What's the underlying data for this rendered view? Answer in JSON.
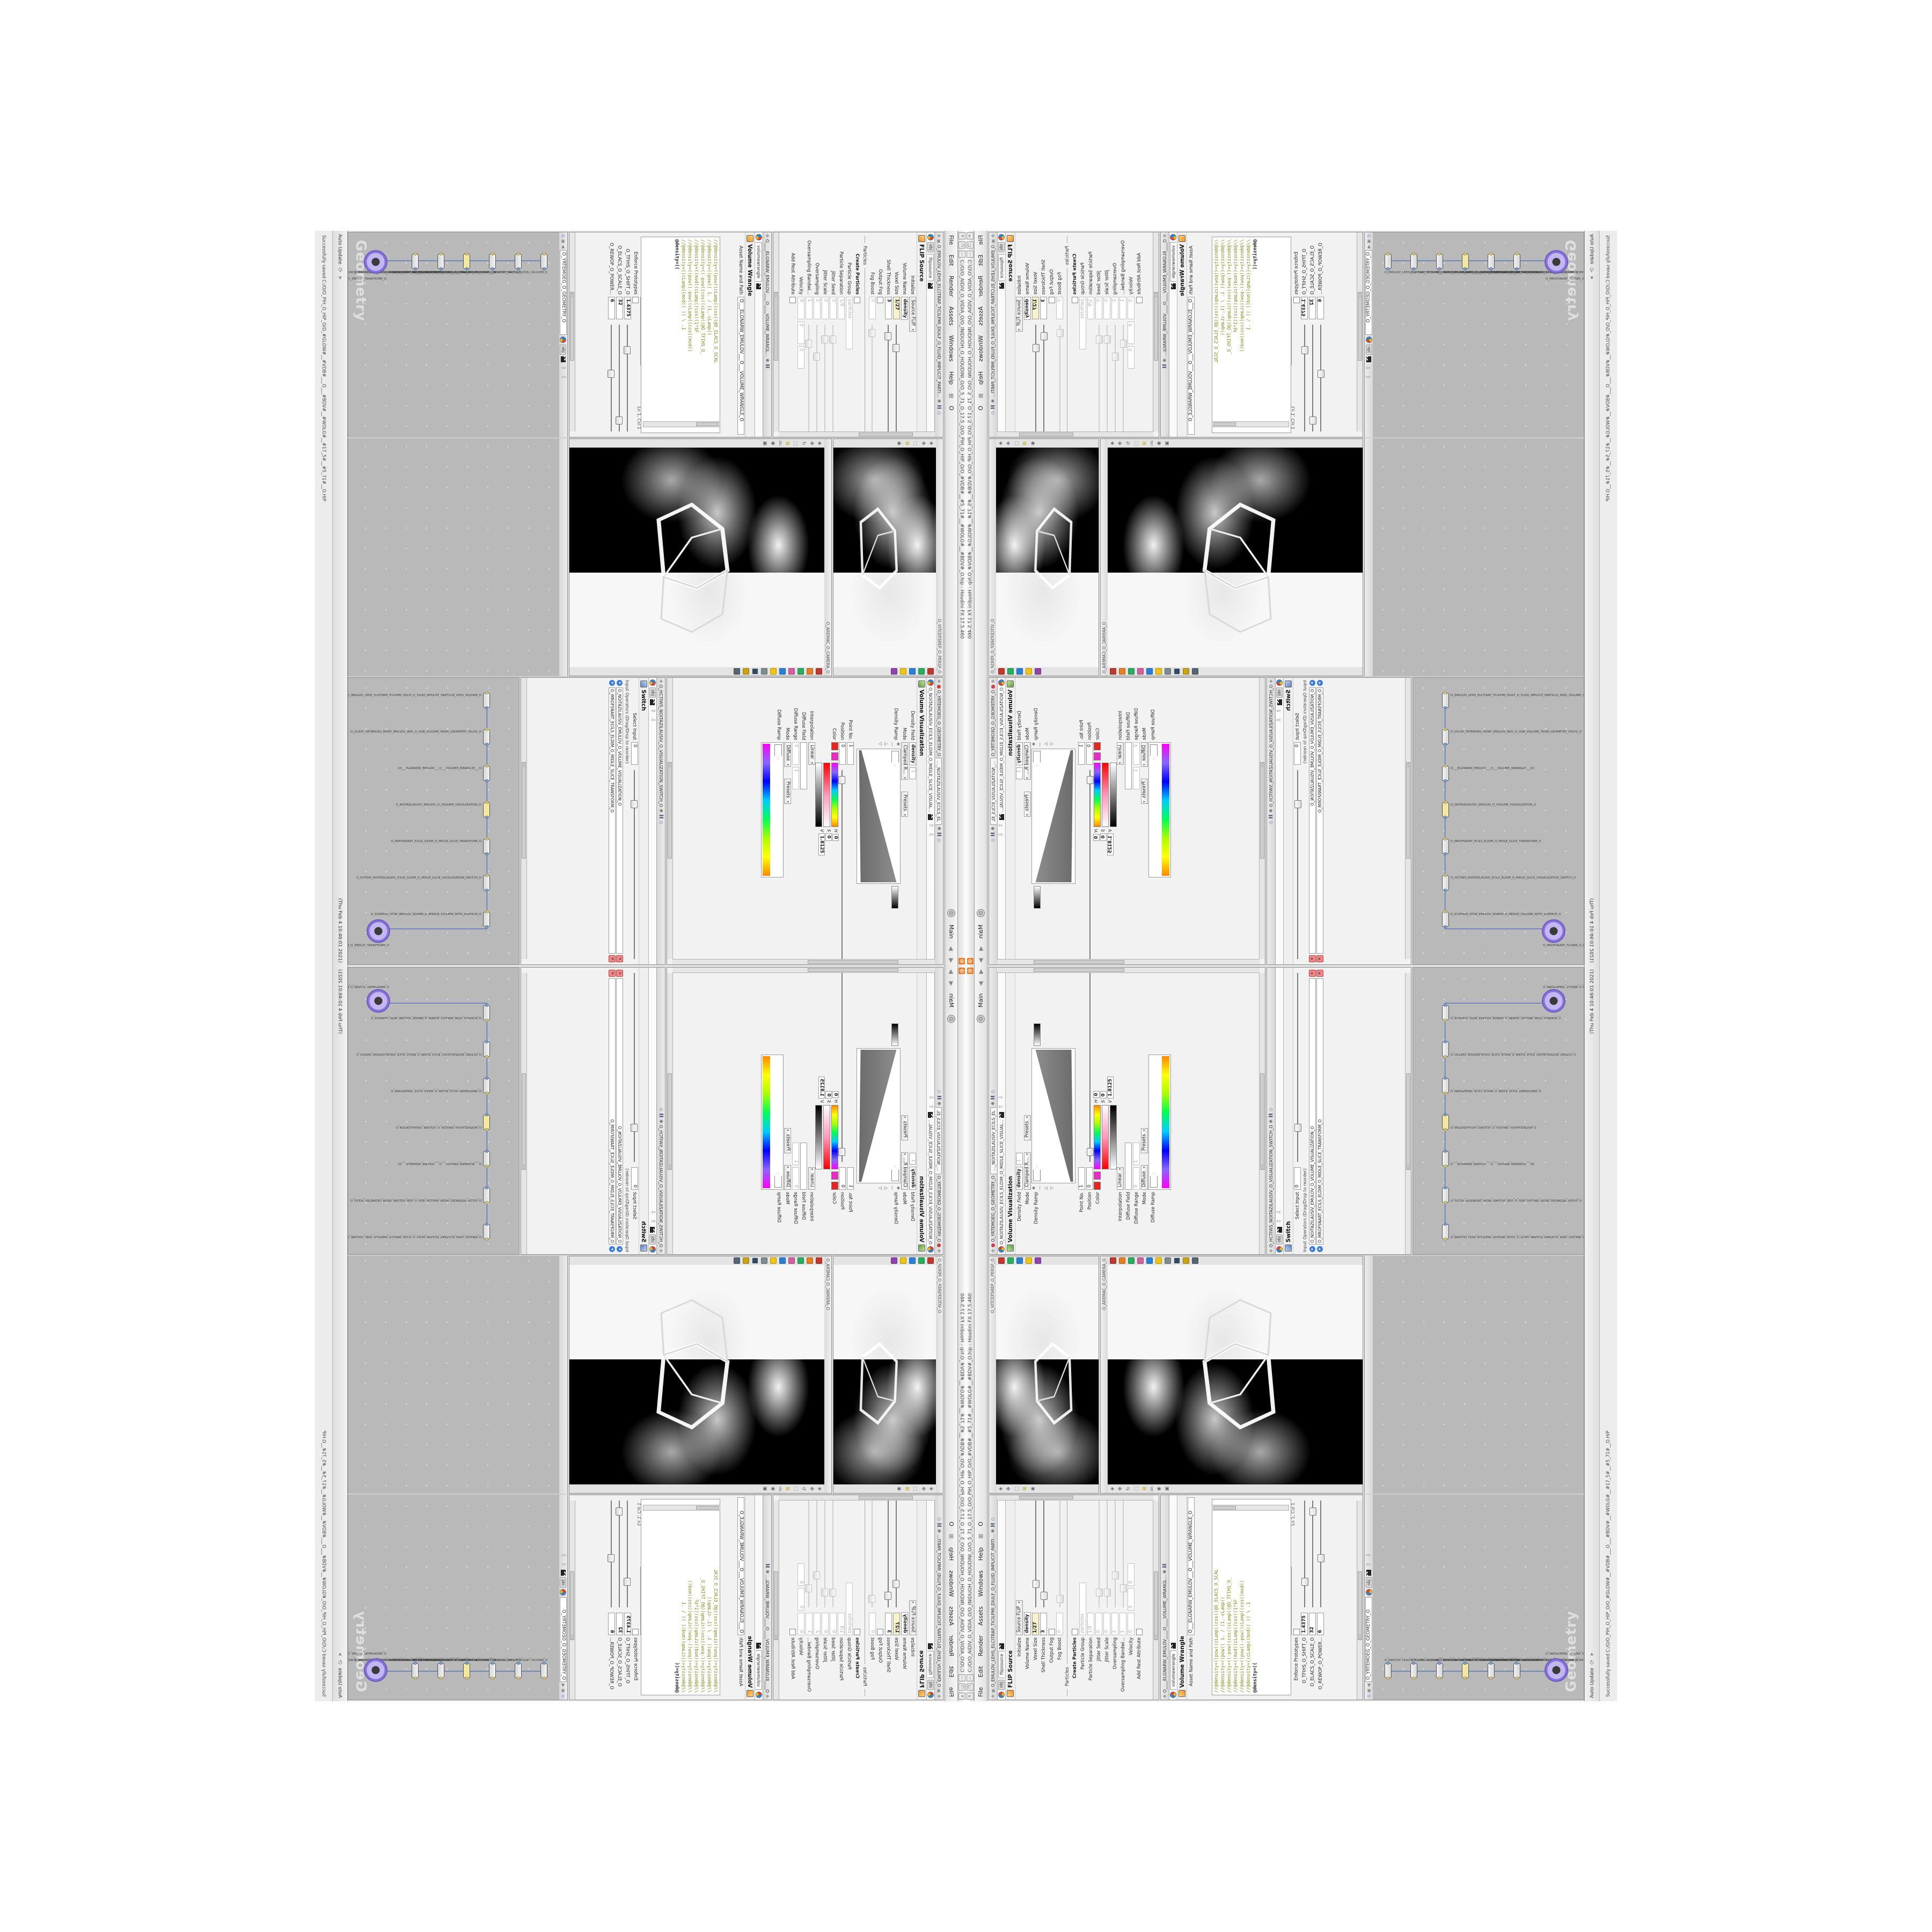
{
  "window": {
    "title": "C:/O/O_AIDIV_O_VIDIA_O/O_INIDUOH_O_HOUDINI_O/O_5_71_O_17.5_O/O_PIH_O_HIP_O/O_#VDB#__#5_71#__#WOLG#__#BDV#_O.hip - Houdini FX 17.5.460",
    "menu": [
      "File",
      "Edit",
      "Render",
      "Assets",
      "Windows",
      "Help"
    ],
    "menu_o": "O",
    "desktop": "Main",
    "close_glyph": "✕",
    "restore_glyph": "❐",
    "min_glyph": "—"
  },
  "status": {
    "update_mode": "Auto Update",
    "message": "Successfully saved C:/O/O_PIH_O_HIP_O/O_#GLOW#__#VDB#___O___#BDV#__#WOLG#__#17_5#__#5_71#__O.HIP",
    "timestamp": "(Thu Feb 4 10:46:01 2021)"
  },
  "flip": {
    "breadcrumb": "O_EMULOV_LEHS_ELCITRAP_TICILPMI_DIULF_O_FLUID_IMPLICIT_PARTI...",
    "tab_obj": "obj",
    "tab": "flipsource",
    "title": "FLIP Source",
    "initialize_label": "Initialize",
    "initialize": "Source FLIP",
    "volume_name_label": "Volume Name",
    "volume_name": "density",
    "voxel_label": "Voxel Size",
    "voxel": "1/27",
    "shell_label": "Shell Thickness",
    "shell": "3",
    "output_fog_label": "Output Fog",
    "fog_boost_label": "Fog Boost",
    "fog_boost": "0",
    "particles_section": "Particles",
    "create_label": "Create Particles",
    "group_label": "Particle Group",
    "group": "particles",
    "sep_label": "Particle Separation",
    "sep": "1/9",
    "jseed_label": "Jitter Seed",
    "jseed": "0",
    "jscale_label": "Jitter Scale",
    "jscale": "0",
    "over_label": "Oversampling",
    "over": "2",
    "overbw_label": "Oversampling Bandwi...",
    "overbw": "1",
    "vel_label": "Velocity",
    "vel0": "0",
    "vel1": "0",
    "vel2": "0",
    "rest_label": "Add Rest Attribute"
  },
  "wrangle": {
    "breadcrumb": "O____ELGNARW_EMULOV____O____VOLUME_WRANGL...",
    "tab": "volumewrangle",
    "title": "Volume Wrangle",
    "asset_label": "Asset Name and Path",
    "asset_value": "O___ELGNARW_EMULOV___O___VOLUME_WRANGLE_O",
    "code": [
      "//@density=((pow((cLamp((cos((@O_ELACS_O_SCAL",
      "//@density=((pow((   1. / (1.-cLamp((",
      "//@density=((-pow((cos((cLamp((@O_TFIHS_O_",
      "//@density=((mod((cLamp((cos((1*$F",
      "//@density=((pow((-pow((cLamp((cos((mod((",
      "//@density=((cLamp((mod((   )) \\ .1",
      "@density=(("
    ],
    "cursor": "Ln 1, Col 1",
    "volumes_label": "Volumes to Write to",
    "volumes_value": "*",
    "enforce_label": "Enforce Prototypes",
    "slider1_label": "O_TFIHS_O_SHIFT_O",
    "slider1_value": "1.4375",
    "slider2_label": "O_ELACS_O_SCALE_O",
    "slider2_value": "32",
    "slider3_label": "O_REWOP_O_POWER...",
    "slider3_value": "6"
  },
  "viz": {
    "breadcrumb": "O_NOITAZILAUSIV_ECILS_ELDIM_O_MIDLE_SLICE_VISUAL...",
    "path2": "O_YRTEMOEG_O_GEOMETRY_O",
    "tab1": "..._NOITAZILAUSIV_ECILS_EL",
    "title": "Volume Visualization",
    "density_field_label": "Density Field",
    "density_field": "density",
    "mode_label": "Mode",
    "mode": "Clamped R...",
    "density_ramp_label": "Density Ramp",
    "point_label": "Point No.",
    "point": "1",
    "position_label": "Position",
    "position": "0",
    "color_label": "Color",
    "interp_label": "Interpolation",
    "interp": "Linear",
    "h_label": "H",
    "h": "0",
    "s_label": "S",
    "s": "0",
    "v_label": "V",
    "v": "1.8125",
    "presets": "Presets",
    "diffuse_field_label": "Diffuse Field",
    "diffuse_range_label": "Diffuse Range",
    "diffuse_range_lo": "0",
    "diffuse_range_hi": "1",
    "mode2_label": "Mode",
    "mode2": "Diffuse",
    "diffuse_ramp_label": "Diffuse Ramp"
  },
  "switch": {
    "breadcrumb": "O_HCTIWS_NOITAZILAUSIV_O_VISUALIZATION_SWITCH_O",
    "title": "Switch",
    "select_label": "Select Input",
    "select": "0",
    "inputs_label": "Input Operators (Drag/Drop to reorder)",
    "input1": "O_NOITAZILAUSIV_EMULOV_O_VOLUME_VISUALIZATION_O",
    "input2": "O_MROFSNART_ECILS_ELDIM_O_MIDLE_SLICE_TRANSFORM_O"
  },
  "network": {
    "path": "O_YRTEMOEG_O_GEOMETRY_O",
    "tab": "obj",
    "watermark": "Geometry",
    "nodes": [
      "O_EMULOV_LEHS_ELCITRAP_TICILPMI_DIULF_O_FLUID_IMPLICIT_PARTICLE_SHEL_VOLUME_O",
      "O_GYLOP_YRTEMOEG_MORF_EMULOV_BDV_O_VDB_VOLUME_FROM_GEOMETRY_POLYG_O",
      "O___ELGNARW_EMULOV___O___VOLUME_WRANGLE___02",
      "O_NOITAZILAUSIV_EMULOV_O_VOLUME_VISUALIZATION_O",
      "O_MROFSNART_ECILS_ELDIM_O_MIDLE_SLICE_TRANSFORM_O",
      "O_HCTIWS_NOITAZILAUSIV_ECILS_ELDIM_O_MIDLE_SLICE_VISUALIZATION_SWITCH_O",
      "O_ECAFRUS_HTIW_EMULOV_EGREM_O_MERGE_VOLUME_WITH_SURFACE_O",
      "O_MROFSNART_TLUSER_O_RESULT_TRANSFORM_O"
    ]
  },
  "viewport": {
    "camera": "O_AREMAC_O_CAMERA_O",
    "camera2": "O_VITCEPSREP_O_PERSP_O"
  },
  "colors": {
    "accent_orange": "#f4771d",
    "selection_purple": "#8a74d8",
    "expression_yellow": "#f7f3c9",
    "code_olive": "#8a8a1d",
    "network_gray": "#b9b9b9"
  }
}
